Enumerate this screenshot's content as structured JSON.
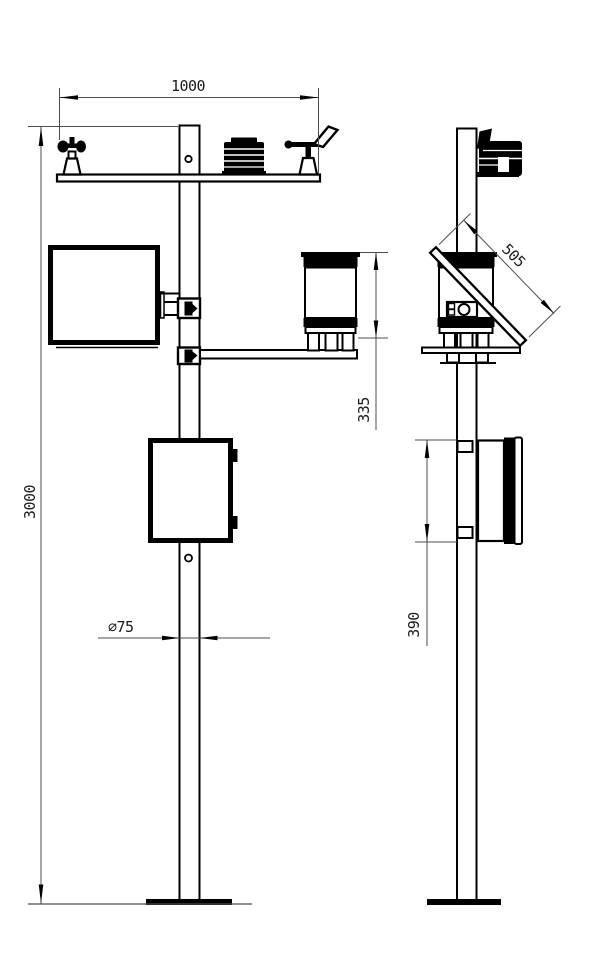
{
  "drawing": {
    "type": "technical-orthographic-drawing",
    "views": [
      "front-view",
      "side-view"
    ],
    "colors": {
      "background": "#ffffff",
      "object_line": "#000000",
      "dimension_line": "#4d4d4d"
    },
    "dimensions": {
      "crossarm_width": "1000",
      "mast_height": "3000",
      "rain_gauge_height": "335",
      "pole_diameter": "∅75",
      "solar_panel_length": "505",
      "enclosure_height": "390"
    }
  }
}
